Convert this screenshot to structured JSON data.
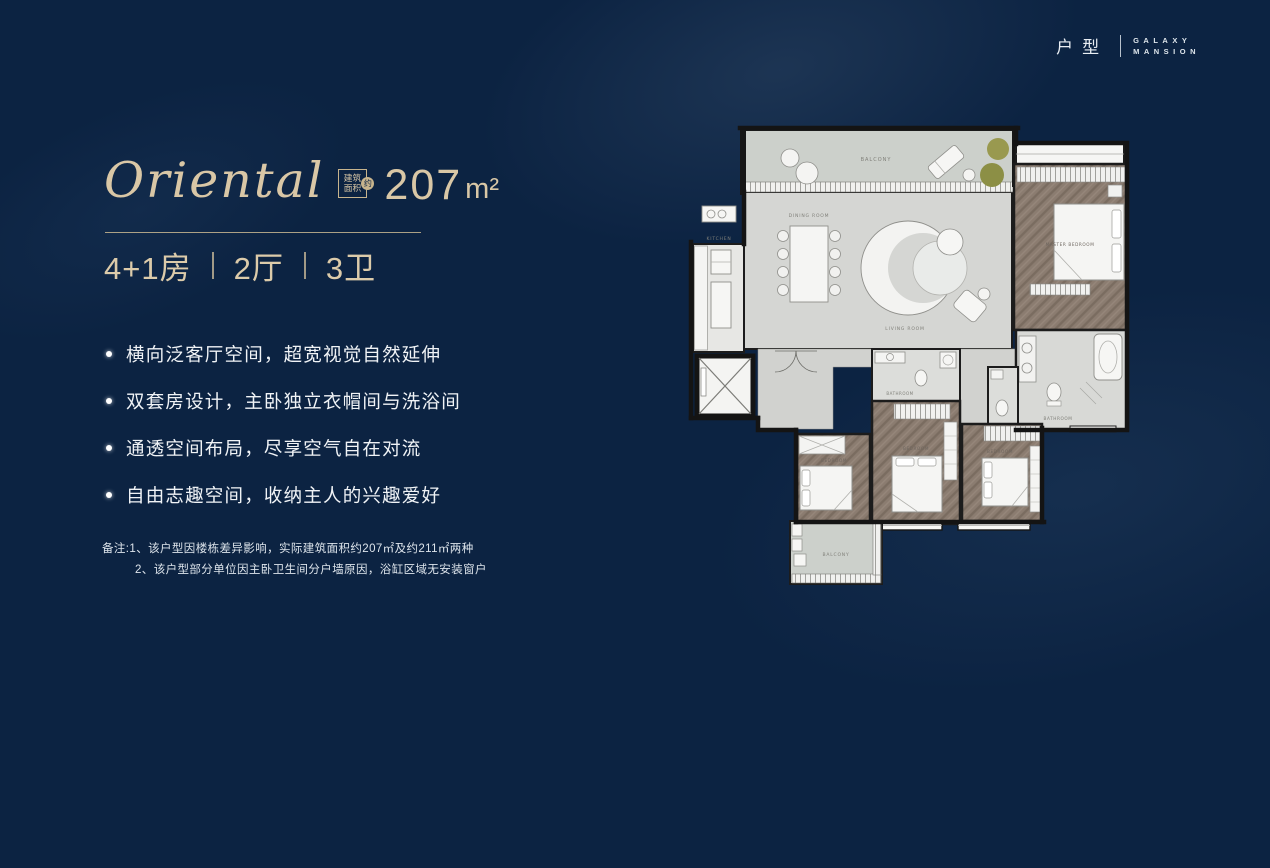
{
  "brand": {
    "cn": "户型",
    "en_line1": "GALAXY",
    "en_line2": "MANSION"
  },
  "headline": {
    "title": "Oriental",
    "badge_line1": "建筑",
    "badge_line2": "面积",
    "badge_circle": "约",
    "area_value": "207",
    "area_unit": "m²"
  },
  "spec": {
    "rooms": "4+1房",
    "halls": "2厅",
    "baths": "3卫"
  },
  "features": [
    "横向泛客厅空间，超宽视觉自然延伸",
    "双套房设计，主卧独立衣帽间与洗浴间",
    "通透空间布局，尽享空气自在对流",
    "自由志趣空间，收纳主人的兴趣爱好"
  ],
  "notes": {
    "line1": "备注:1、该户型因楼栋差异影响，实际建筑面积约207㎡及约211㎡两种",
    "line2": "2、该户型部分单位因主卧卫生间分户墙原因，浴缸区域无安装窗户"
  },
  "floorplan": {
    "labels": {
      "balcony": "BALCONY",
      "dining": "DINING ROOM",
      "living": "LIVING ROOM",
      "kitchen": "KITCHEN",
      "master_bedroom": "MASTER BEDROOM",
      "master_bath": "BATHROOM",
      "bath": "BATHROOM",
      "bedroom1": "BEDROOM",
      "bedroom2": "BEDROOM",
      "bedroom3": "BEDROOM",
      "balcony2": "BALCONY"
    }
  },
  "colors": {
    "background": "#0c2342",
    "accent": "#d9c7a6",
    "text": "#f0f3f6",
    "wood": "#8b7c70",
    "floor": "#d5d6d3"
  }
}
